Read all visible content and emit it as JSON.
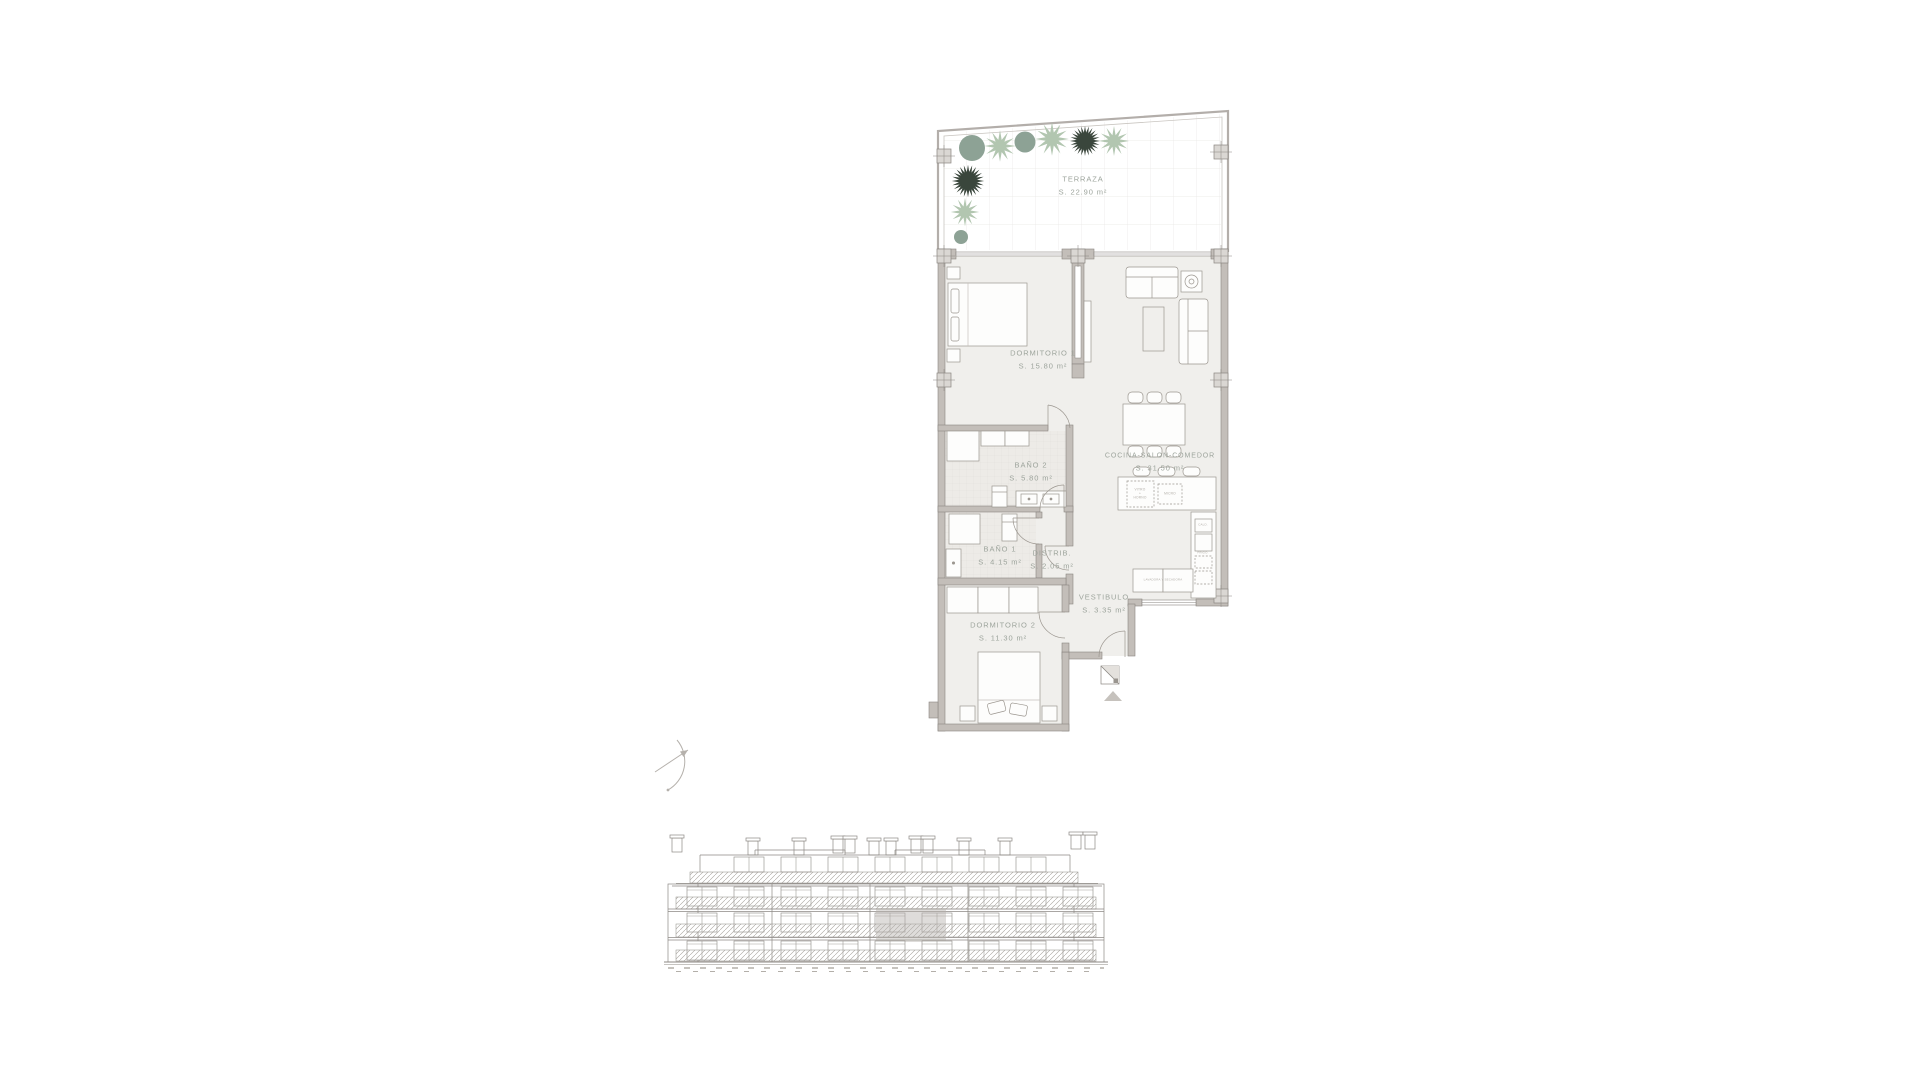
{
  "floor_plan": {
    "rooms": [
      {
        "name": "TERRAZA",
        "area": "S. 22.90 m²"
      },
      {
        "name": "DORMITORIO 1",
        "area": "S. 15.80 m²"
      },
      {
        "name": "COCINA-SALON-COMEDOR",
        "area": "S. 31.50 m²"
      },
      {
        "name": "BAÑO 2",
        "area": "S. 5.80 m²"
      },
      {
        "name": "BAÑO 1",
        "area": "S. 4.15 m²"
      },
      {
        "name": "DISTRIB.",
        "area": "S. 2.05 m²"
      },
      {
        "name": "VESTIBULO",
        "area": "S. 3.35 m²"
      },
      {
        "name": "DORMITORIO 2",
        "area": "S. 11.30 m²"
      }
    ],
    "annotations": {
      "island_line1": "VITRO",
      "island_line2": "+",
      "island_line3": "HORNO",
      "micro": "MICRO",
      "cald": "CALD.",
      "frigo": "FRIGO.",
      "closet": "LAVADORA Y SECADORA"
    },
    "colors": {
      "wall": "#c3beb9",
      "wall_outline": "#8a8681",
      "room_fill": "#f0efec",
      "bath_tile": "#edebe7",
      "label": "#9da49c",
      "plant_sage": "#8da295",
      "plant_light": "#b2c6b0",
      "plant_dark": "#3a463c",
      "elevation_highlight": "#b6b2ad"
    }
  }
}
